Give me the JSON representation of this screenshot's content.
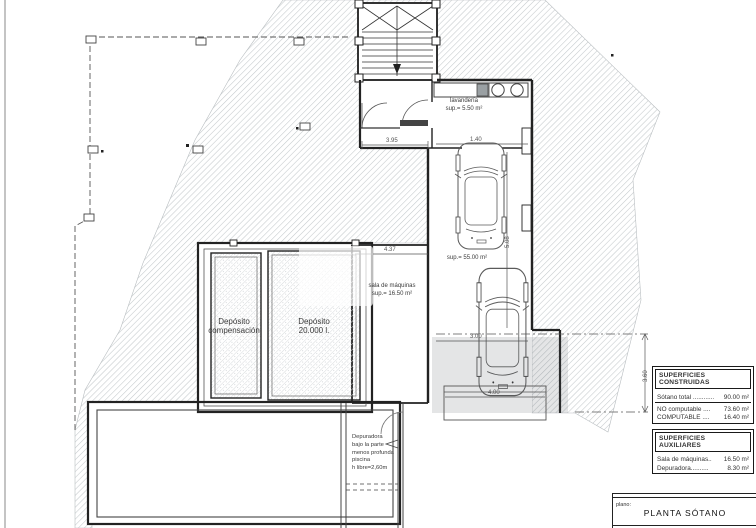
{
  "drawing": {
    "rooms": {
      "laundry": {
        "name": "lavandería",
        "area": "sup.= 5.50 m²"
      },
      "machine_room": {
        "name": "sala de máquinas",
        "area": "sup.= 16.50 m²"
      },
      "garage": {
        "area": "sup.= 55.00 m²"
      },
      "tank_compensation": {
        "line1": "Depósito",
        "line2": "compensación"
      },
      "tank_main": {
        "line1": "Depósito",
        "line2": "20.000 l."
      },
      "purifier_note": {
        "line1": "Depuradora",
        "line2": "bajo la parte",
        "line3": "menos profunda piscina",
        "line4": "h libre=2,60m"
      }
    },
    "dimensions": {
      "hall_width": "3.95",
      "garage_bay": "1.40",
      "garage_length": "5.08",
      "machine_room_width": "4.37",
      "car_length": "3.00",
      "ramp_width": "4.00",
      "ramp_height": "3.60"
    }
  },
  "areas_table": {
    "constructed": {
      "header": "SUPERFICIES CONSTRUIDAS",
      "rows": [
        {
          "label": "Sótano total ............",
          "value": "90.00 m²"
        },
        {
          "label": "NO computable ....",
          "value": "73.60 m²"
        },
        {
          "label": "COMPUTABLE     ....",
          "value": "16.40 m²"
        }
      ]
    },
    "auxiliary": {
      "header": "SUPERFICIES AUXILIARES",
      "rows": [
        {
          "label": "Sala de máquinas..",
          "value": "16.50 m²"
        },
        {
          "label": "Depuradora..........",
          "value": "8.30 m²"
        }
      ]
    }
  },
  "title_block": {
    "label": "plano:",
    "title": "PLANTA SÓTANO"
  },
  "colors": {
    "line": "#3c3c3c",
    "wall": "#1e1e1e",
    "hatch": "#c3c8cb",
    "text": "#3a3a3a"
  }
}
